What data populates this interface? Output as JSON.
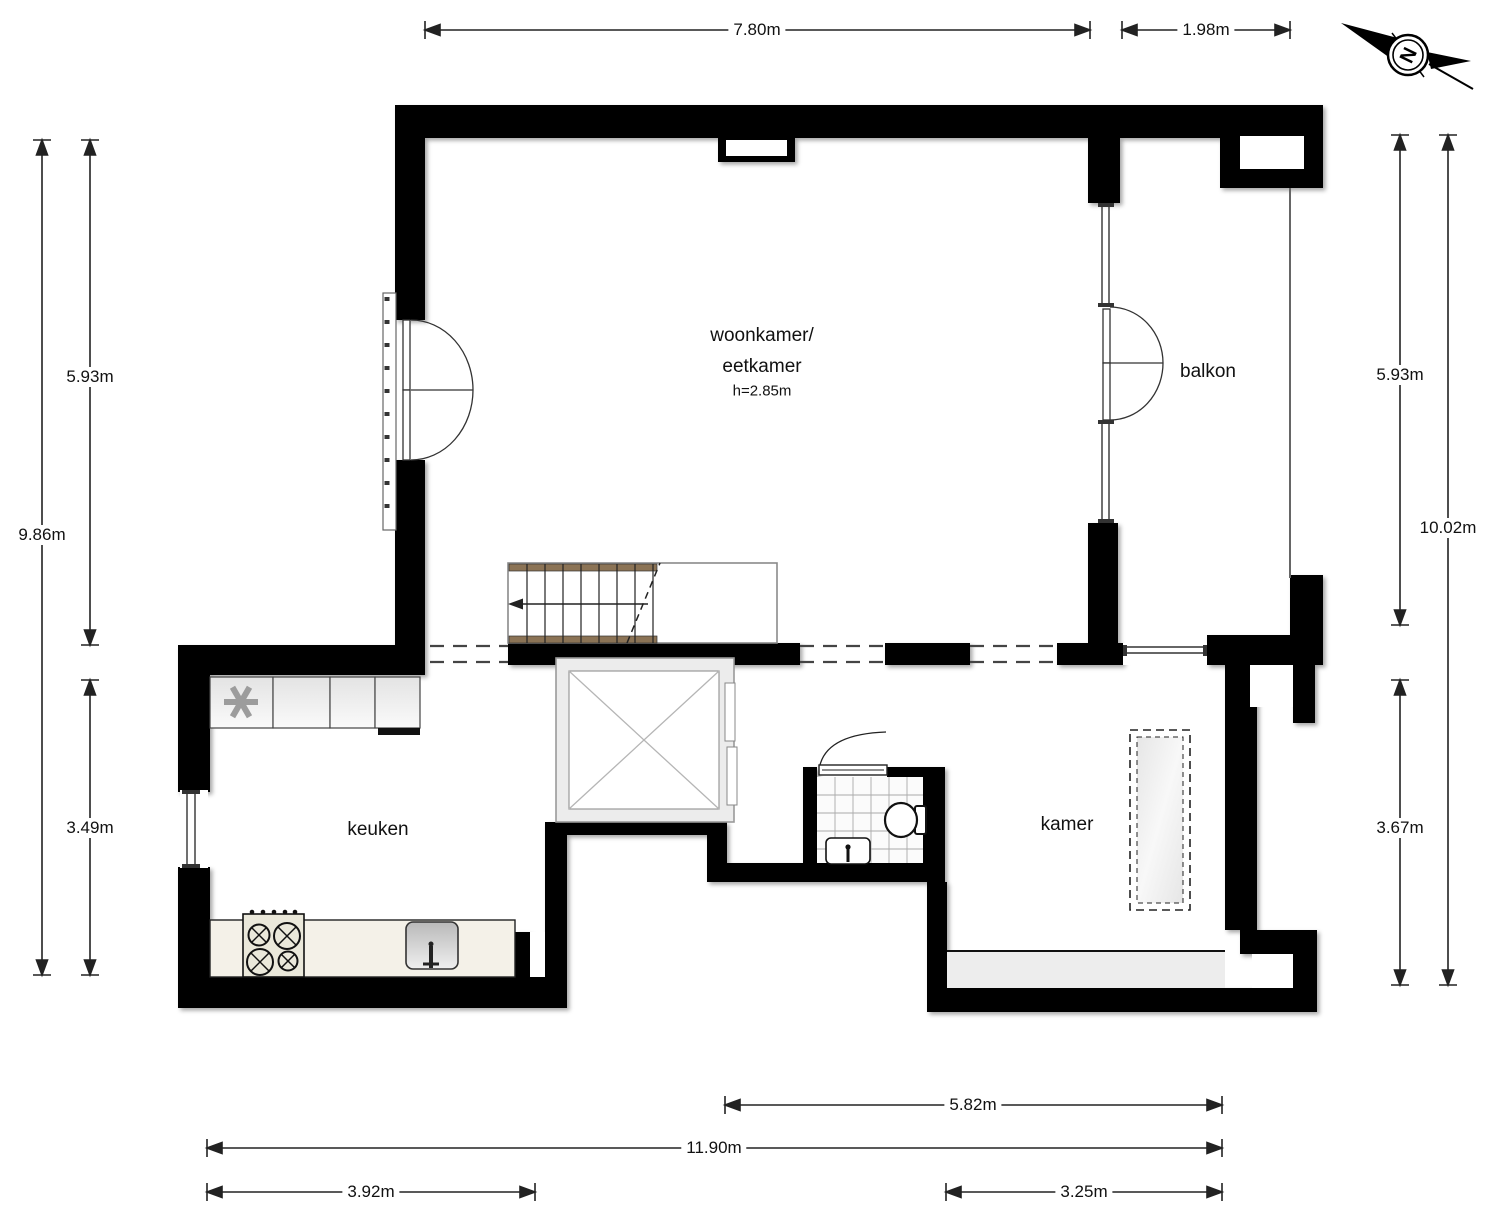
{
  "rooms": {
    "living_room": {
      "name_line1": "woonkamer/",
      "name_line2": "eetkamer",
      "ceiling_height": "h=2.85m"
    },
    "balcony": {
      "name": "balkon"
    },
    "kitchen": {
      "name": "keuken"
    },
    "bedroom": {
      "name": "kamer"
    }
  },
  "compass": {
    "north_label": "N"
  },
  "dimensions": {
    "top_width_main": "7.80m",
    "top_width_balcony": "1.98m",
    "left_height_upper": "5.93m",
    "left_height_total": "9.86m",
    "left_height_lower": "3.49m",
    "right_height_upper": "5.93m",
    "right_height_total": "10.02m",
    "right_height_lower": "3.67m",
    "bottom_width_room": "5.82m",
    "bottom_width_total": "11.90m",
    "bottom_width_kitchen": "3.92m",
    "bottom_width_right": "3.25m"
  },
  "colors": {
    "wall": "#000000",
    "counter": "#f4f1e8",
    "stair_stringer": "#8b7355",
    "elevator_frame": "#ececec",
    "window_band": "#ededed"
  }
}
